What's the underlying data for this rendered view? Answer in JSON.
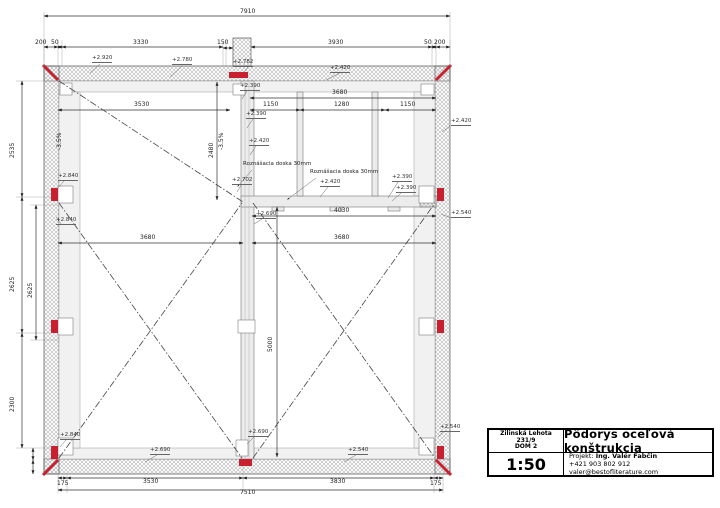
{
  "title_block": {
    "location": "Žilinská Lehota",
    "parcel": "231/9",
    "house": "DOM 2",
    "title": "Pôdorys oceľová konštrukcia",
    "scale": "1:50",
    "project_label": "Projekt:",
    "project_name": "Ing. Valér Fabčin",
    "contact": "+421 903 802 912 valer@bestofliterature.com"
  },
  "dims": {
    "overall_top": "7910",
    "t200": "200",
    "t50": "50",
    "t3330": "3330",
    "t150": "150",
    "t3930": "3930",
    "b175": "175",
    "b3530": "3530",
    "b3830": "3830",
    "overall_bottom": "7510",
    "l2535": "2535",
    "l2625": "2625",
    "l2300": "2300",
    "m3530": "3530",
    "m3680": "3680",
    "c1150": "1150",
    "c1280": "1280",
    "v2480": "2480",
    "m4030": "4030",
    "v5000": "5000",
    "s150": "150"
  },
  "levels": {
    "l2920": "+2.920",
    "l2780": "+2.780",
    "l2782": "+2.782",
    "l2420": "+2.420",
    "l2390": "+2.390",
    "l2702": "+2.702",
    "l2840": "+2.840",
    "l2690": "+2.690",
    "l2540": "+2.540"
  },
  "slope": "-3.5%",
  "note_doska": "Roznášacia doska 30mm",
  "colors": {
    "accent_red": "#c8202f",
    "line": "#333333",
    "hatch": "#b5b5b5"
  }
}
